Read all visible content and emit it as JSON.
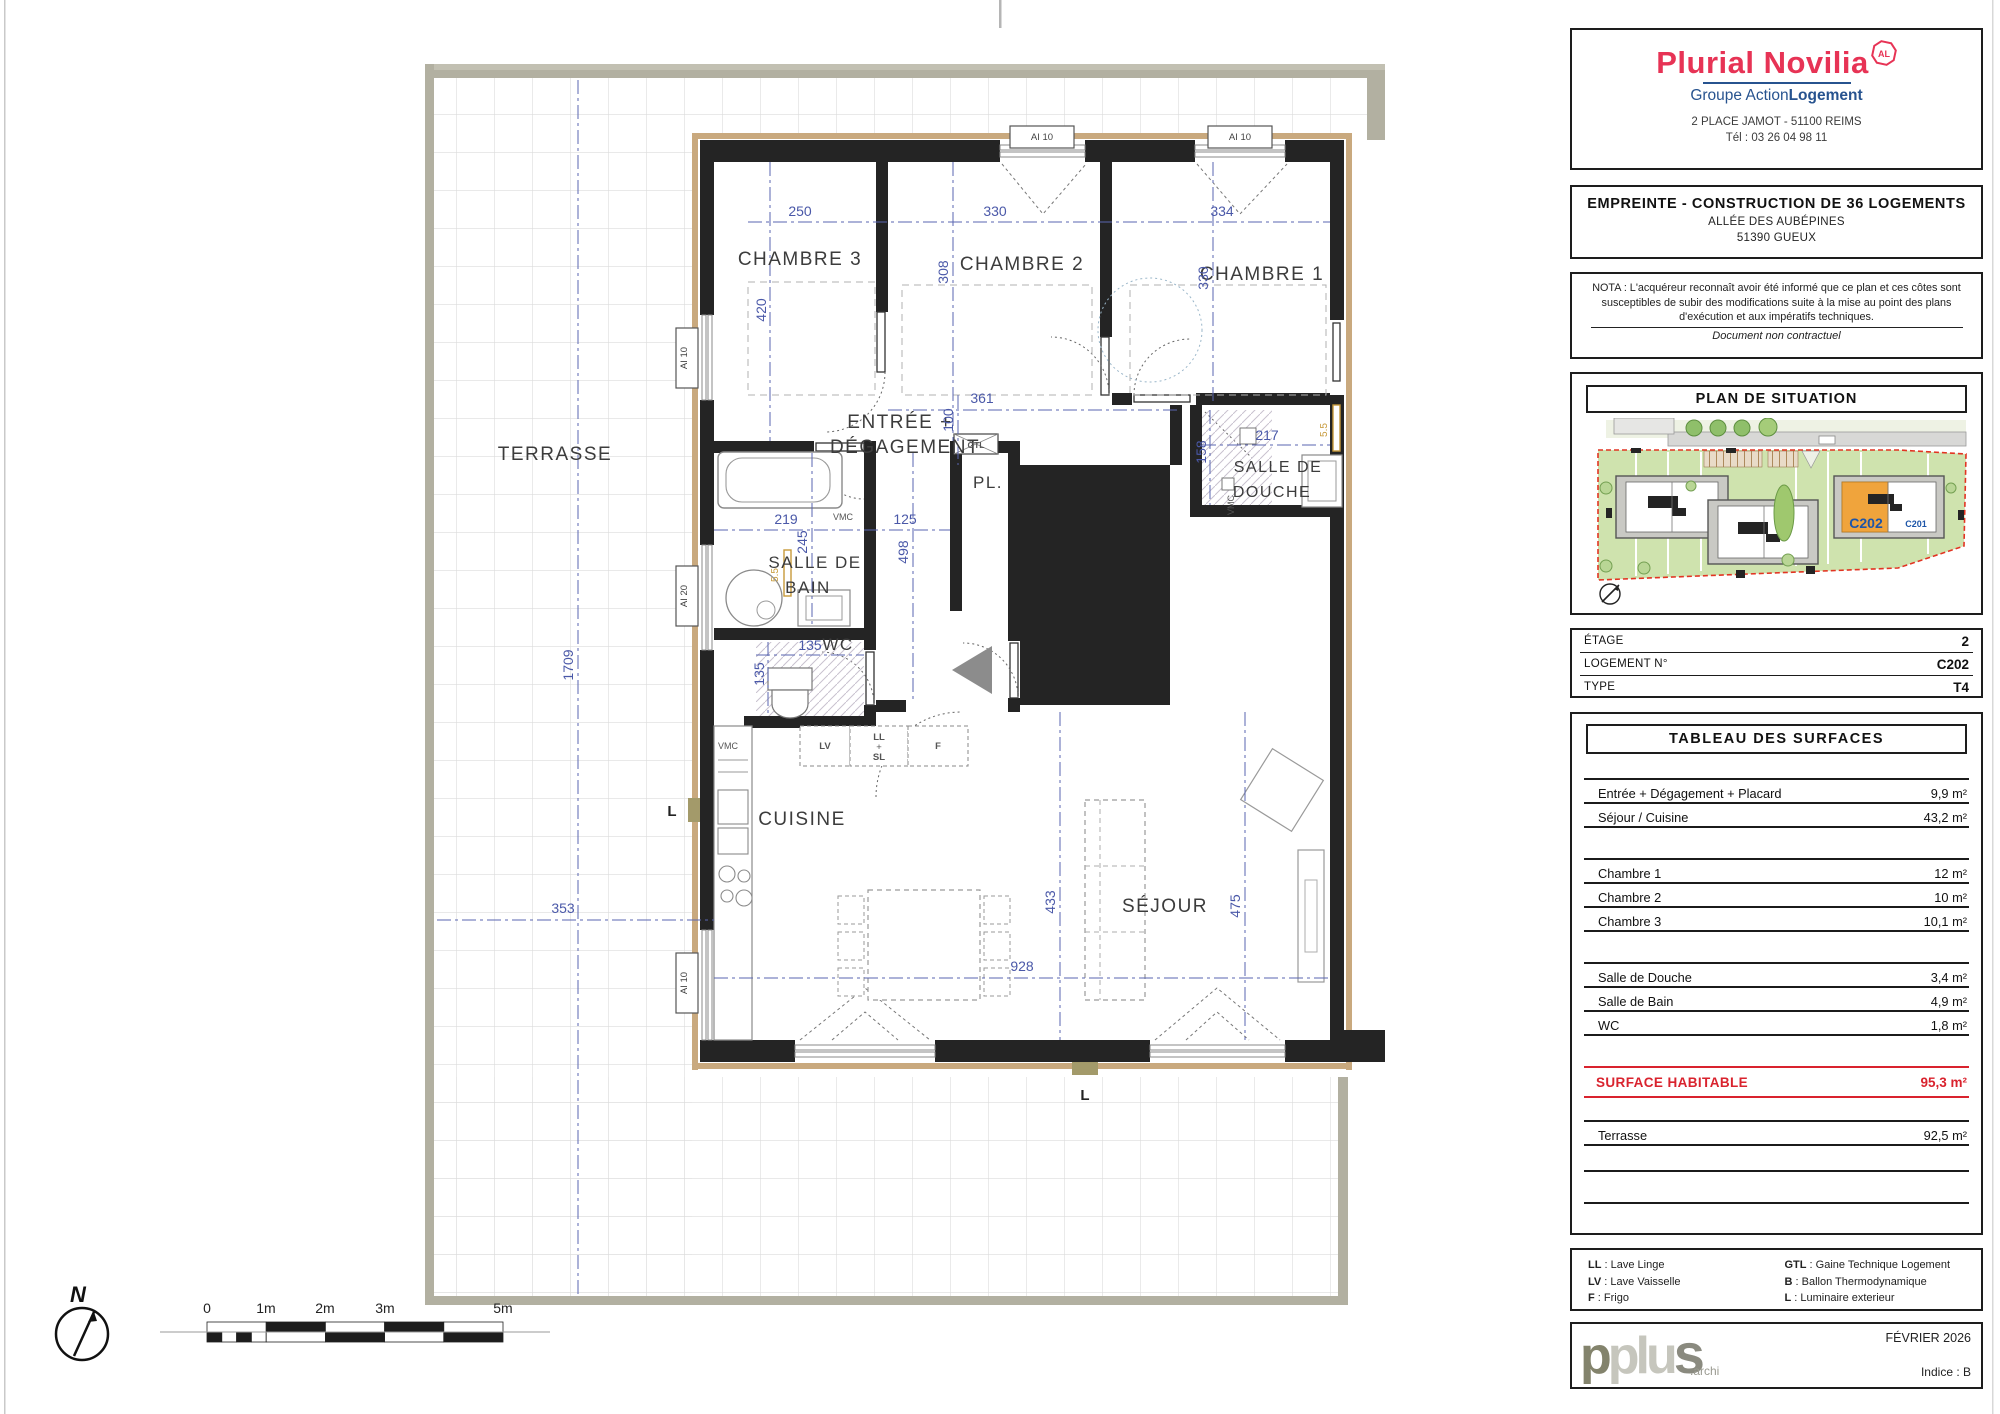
{
  "plan": {
    "labels": {
      "terrasse": "TERRASSE",
      "chambre3": "CHAMBRE 3",
      "chambre2": "CHAMBRE 2",
      "chambre1": "CHAMBRE 1",
      "entree1": "ENTRÉE +",
      "entree2": "DÉGAGEMENT",
      "pl": "PL.",
      "sdb1": "SALLE DE",
      "sdb2": "BAIN",
      "wc": "WC",
      "sdd1": "SALLE DE",
      "sdd2": "DOUCHE",
      "cuisine": "CUISINE",
      "sejour": "SÉJOUR",
      "d250": "250",
      "d330": "330",
      "d334": "334",
      "d420": "420",
      "d308": "308",
      "d330b": "330",
      "d361": "361",
      "d100": "100",
      "d219": "219",
      "d245": "245",
      "d125": "125",
      "d498": "498",
      "d135": "135",
      "d158": "158",
      "d217": "217",
      "d433": "433",
      "d475": "475",
      "d928": "928",
      "d353": "353",
      "d1709": "1709",
      "ai10": "AI 10",
      "ai20": "AI 20",
      "vmc": "VMC",
      "gtl": "GTL",
      "lv": "LV",
      "ll": "LL",
      "plus_sign": "+",
      "sl": "SL",
      "f": "F",
      "lum": "L",
      "r55": "5.5"
    },
    "compass_n": "N",
    "scalebar": {
      "t0": "0",
      "t1": "1m",
      "t2": "2m",
      "t3": "3m",
      "t5": "5m"
    }
  },
  "sidebar": {
    "logo": {
      "brand": "Plurial Novilia",
      "badge": "AL",
      "group_a": "Groupe Action",
      "group_b": "Logement",
      "address_line1": "2 PLACE JAMOT - 51100 REIMS",
      "address_line2": "Tél : 03 26 04 98 11"
    },
    "project": {
      "title": "EMPREINTE - CONSTRUCTION DE 36 LOGEMENTS",
      "line1": "ALLÉE DES AUBÉPINES",
      "line2": "51390 GUEUX"
    },
    "nota": {
      "text": "NOTA : L'acquéreur reconnaît avoir été informé que ce plan et ces côtes sont susceptibles de subir des modifications suite à la mise au point des plans d'exécution et aux impératifs techniques.",
      "footnote": "Document non contractuel"
    },
    "situation": {
      "title": "PLAN DE SITUATION",
      "unit_current": "C202",
      "unit_neighbor": "C201"
    },
    "unit": {
      "rows": [
        {
          "label": "ÉTAGE",
          "value": "2"
        },
        {
          "label": "LOGEMENT N°",
          "value": "C202"
        },
        {
          "label": "TYPE",
          "value": "T4"
        }
      ]
    },
    "surfaces": {
      "title": "TABLEAU DES SURFACES",
      "rows": [
        {
          "label": "Entrée + Dégagement + Placard",
          "value": "9,9 m²"
        },
        {
          "label": "Séjour / Cuisine",
          "value": "43,2 m²"
        },
        {
          "label": "Chambre 1",
          "value": "12 m²"
        },
        {
          "label": "Chambre 2",
          "value": "10 m²"
        },
        {
          "label": "Chambre 3",
          "value": "10,1 m²"
        },
        {
          "label": "Salle de Douche",
          "value": "3,4 m²"
        },
        {
          "label": "Salle de Bain",
          "value": "4,9 m²"
        },
        {
          "label": "WC",
          "value": "1,8 m²"
        }
      ],
      "total_label": "SURFACE HABITABLE",
      "total_value": "95,3 m²",
      "terrace_label": "Terrasse",
      "terrace_value": "92,5 m²"
    },
    "legend": {
      "items": [
        {
          "abbr": "LL",
          "desc": " : Lave Linge"
        },
        {
          "abbr": "LV",
          "desc": " : Lave Vaisselle"
        },
        {
          "abbr": "F",
          "desc": " : Frigo"
        },
        {
          "abbr": "GTL",
          "desc": " : Gaine Technique Logement"
        },
        {
          "abbr": "B",
          "desc": " : Ballon Thermodynamique"
        },
        {
          "abbr": "L",
          "desc": " : Luminaire exterieur"
        }
      ]
    },
    "footer": {
      "logo_p": "p",
      "logo_plus": "plu",
      "logo_s": "s",
      "logo_archi": ".archi",
      "date": "FÉVRIER 2026",
      "indice": "Indice : B"
    }
  }
}
